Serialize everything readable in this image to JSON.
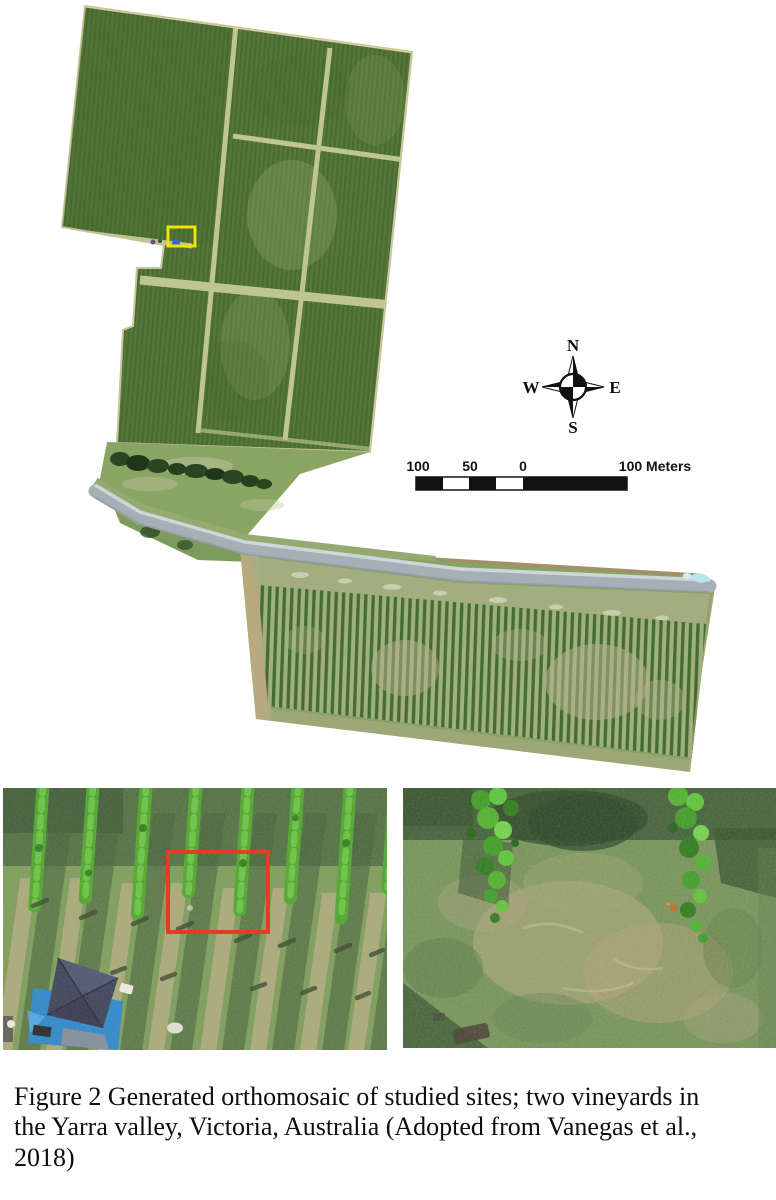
{
  "figure": {
    "caption": "Figure 2 Generated orthomosaic of studied sites; two vineyards in the Yarra valley, Victoria, Australia (Adopted from Vanegas et al., 2018)"
  },
  "map": {
    "compass": {
      "north": "N",
      "east": "E",
      "south": "S",
      "west": "W"
    },
    "scale_bar": {
      "label_100": "100",
      "label_50": "50",
      "label_0": "0",
      "label_right": "100 Meters"
    },
    "annotations": {
      "site_marker_color": "#f2e200",
      "roi_color": "#e23018"
    }
  }
}
